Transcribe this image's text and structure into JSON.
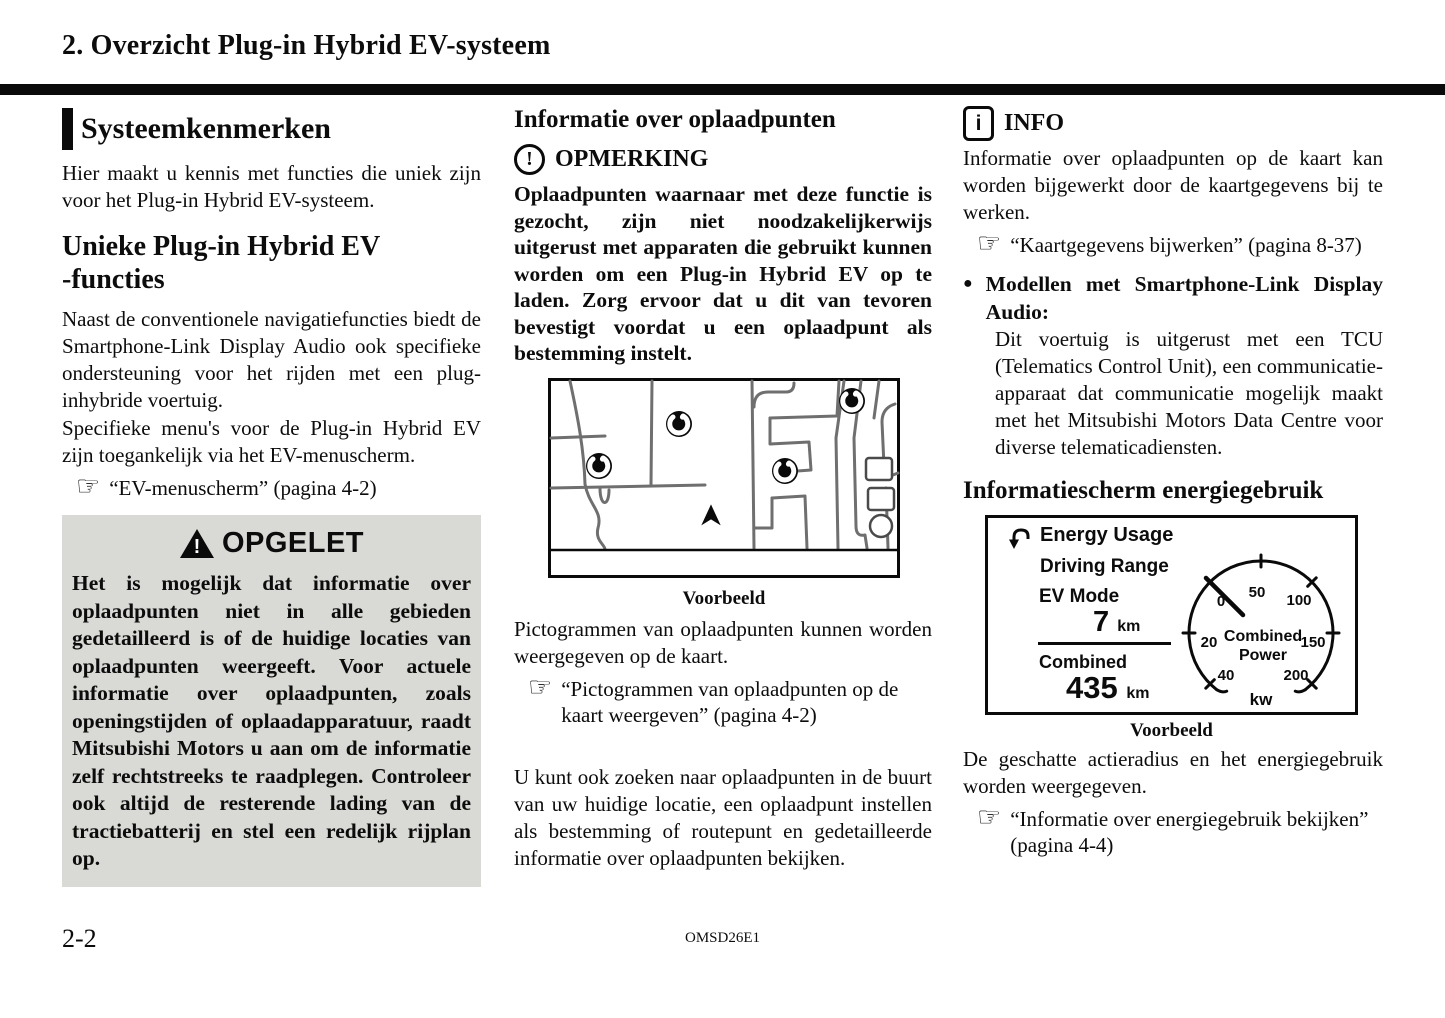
{
  "header": {
    "title": "2. Overzicht Plug-in Hybrid EV-systeem"
  },
  "left": {
    "section_title": "Systeemkenmerken",
    "intro": "Hier maakt u kennis met functies die uniek zijn voor het Plug-in Hybrid EV-systeem.",
    "subtitle_line1": "Unieke Plug-in Hybrid EV",
    "subtitle_line2": "-functies",
    "para1": "Naast de conventionele navigatiefuncties biedt de Smartphone-Link Display Audio ook specifieke ondersteuning voor het rijden met een plug-inhybride voertuig.",
    "para2": "Specifieke menu's voor de Plug-in Hybrid EV zijn toegankelijk via het EV-menuscherm.",
    "ref1": "“EV-menuscherm” (pagina 4-2)",
    "caution_title": "OPGELET",
    "caution_body": "Het is mogelijk dat informatie over oplaadpunten niet in alle gebieden gedetailleerd is of de huidige locaties van oplaadpunten weergeeft. Voor actuele informatie over oplaadpunten, zoals openingstijden of oplaadapparatuur, raadt Mitsubishi Motors u aan om de informatie zelf rechtstreeks te raadplegen. Controleer ook altijd de resterende lading van de tractiebatterij en stel een redelijk rijplan op."
  },
  "middle": {
    "title": "Informatie over oplaadpunten",
    "note_title": "OPMERKING",
    "note_exclamation": "!",
    "note_body": "Oplaadpunten waarnaar met deze functie is gezocht, zijn niet noodzakelijkerwijs uitgerust met apparaten die gebruikt kunnen worden om een Plug-in Hybrid EV op te laden. Zorg ervoor dat u dit van tevoren bevestigt voordat u een oplaadpunt als bestemming instelt.",
    "map_caption": "Voorbeeld",
    "para1": "Pictogrammen van oplaadpunten kunnen worden weergegeven op de kaart.",
    "ref1": "“Pictogrammen van oplaadpunten op de kaart weergeven” (pagina 4-2)",
    "para2": "U kunt ook zoeken naar oplaadpunten in de buurt van uw huidige locatie, een oplaadpunt instellen als bestemming of routepunt en gedetailleerde informatie over oplaadpunten bekijken."
  },
  "right": {
    "info_title": "INFO",
    "info_i": "i",
    "info_body": "Informatie over oplaadpunten op de kaart kan worden bijgewerkt door de kaartgegevens bij te werken.",
    "ref1": "“Kaartgegevens bijwerken” (pagina 8-37)",
    "bullet_glyph": "●",
    "bullet_title": "Modellen met Smartphone-Link Display Audio:",
    "bullet_body": "Dit voertuig is uitgerust met een TCU (Telematics Control Unit), een communicatie-apparaat dat communicatie mogelijk maakt met het Mitsubishi Motors Data Centre voor diverse telematicadiensten.",
    "section_title": "Informatiescherm energiegebruik",
    "screen": {
      "title": "Energy Usage",
      "row1": "Driving Range",
      "row2": "EV Mode",
      "ev_value": "7",
      "ev_unit": "km",
      "combined_label": "Combined",
      "combined_value": "435",
      "combined_unit": "km",
      "gauge_center_line1": "Combined",
      "gauge_center_line2": "Power",
      "gauge_unit": "kw",
      "gauge_ticks": [
        "0",
        "50",
        "100",
        "150",
        "200",
        "20",
        "40"
      ]
    },
    "screen_caption": "Voorbeeld",
    "para1": "De geschatte actieradius en het energiegebruik worden weergegeven.",
    "ref2": "“Informatie over energiegebruik bekijken” (pagina 4-4)"
  },
  "icons": {
    "hand": "☞",
    "warning_exclamation": "!"
  },
  "footer": {
    "page_number": "2-2",
    "doc_code": "OMSD26E1"
  }
}
